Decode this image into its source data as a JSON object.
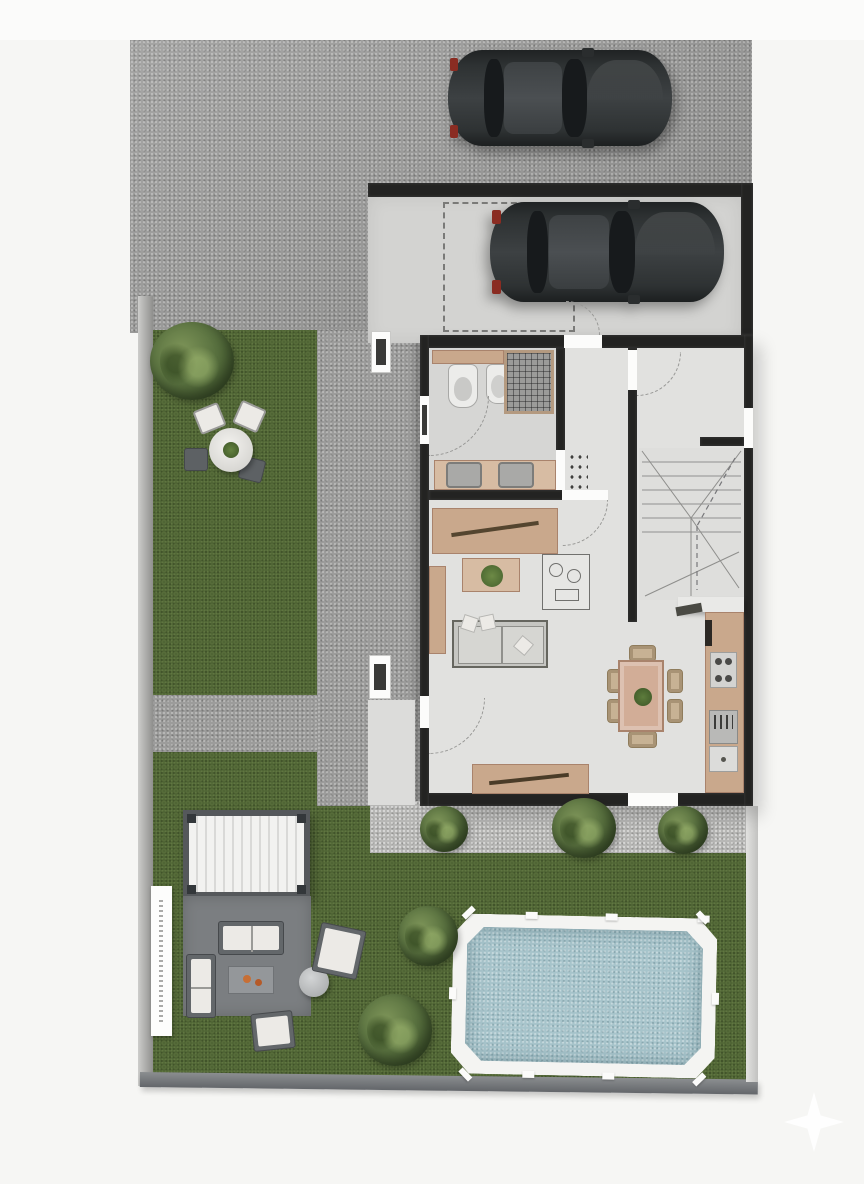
{
  "scene": {
    "type": "3d-top-down-floor-plan-render",
    "rooms": [
      "carport",
      "bathroom",
      "hallway",
      "entry-vestibule",
      "staircase",
      "living-dining-room",
      "kitchen"
    ],
    "outdoor_areas": [
      "street-pavement",
      "driveway",
      "upper-lawn",
      "garden-path",
      "entry-patio",
      "rear-garden",
      "gravel-bed",
      "pergola-lounge",
      "pool-terrace"
    ],
    "objects": [
      "parked-car-street",
      "parked-car-carport",
      "toilet",
      "bidet",
      "shower",
      "double-sink-vanity",
      "sideboard",
      "living-sofa",
      "coffee-table",
      "lounge-sketch-cart",
      "dining-table",
      "dining-chairs",
      "kitchen-counter",
      "stove",
      "kitchen-sink",
      "garden-round-table",
      "garden-chairs",
      "pergola",
      "outdoor-loveseat",
      "outdoor-chaise",
      "outdoor-coffee-table",
      "outdoor-side-table",
      "outdoor-armchairs",
      "swimming-pool",
      "trees",
      "shrubs",
      "boundary-wall",
      "vertical-sign",
      "sparkle-watermark"
    ]
  },
  "colors": {
    "bg": "#f6f6f4",
    "bg-top": "#fbfbfa",
    "street": "#9c9c9b",
    "carport-floor": "#d3d3d1",
    "house-floor": "#e1e1df",
    "bath-floor": "#d6d6d4",
    "wall": "#232322",
    "wall-light": "#3a3a38",
    "lawn": "#4d6233",
    "lawn-dark": "#3d522a",
    "gravel": "#b7b7b5",
    "patio": "#dcdcda",
    "deck": "#7b7e81",
    "pergola-frame": "#55585b",
    "pergola-roof": "#f2f2f0",
    "pergola-slat": "#d9d9d7",
    "pool-coping": "#f4f4f2",
    "pool-water": "#a7c4cb",
    "pool-dot": "#c4d9dd",
    "tan": "#c9a88c",
    "tan-light": "#d7bca3",
    "tan-dark": "#a9836c",
    "furn-gray": "#a9a9a7",
    "furn-dark": "#5f6362",
    "cushion": "#eceae6",
    "wicker": "#c7b294",
    "wicker-edge": "#8f7c5c",
    "car-body": "#2c2f30",
    "car-roof": "#44484a",
    "glass": "#171a1c",
    "taillight": "#8a2c22",
    "plant": "#4e6b33",
    "arc": "#979795",
    "dashline": "#7a7a78",
    "boundary": "#9a9a98",
    "sign": "#fdfdfc",
    "orange": "#c76f35"
  }
}
